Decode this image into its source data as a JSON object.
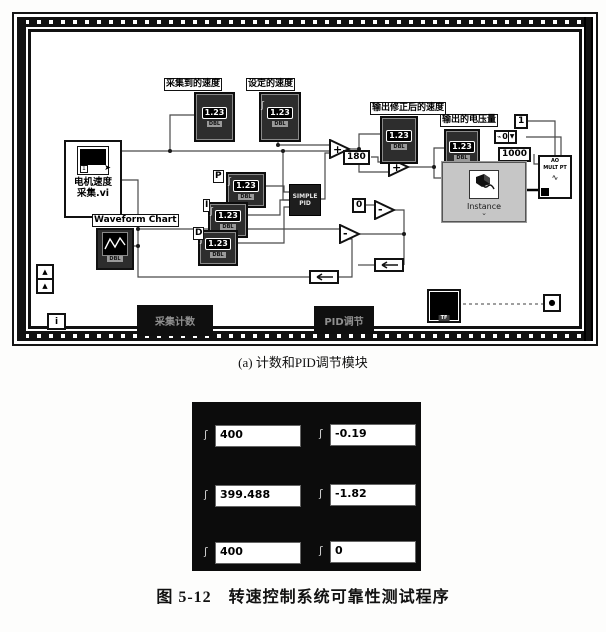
{
  "captions": {
    "sub": "(a) 计数和PID调节模块",
    "main": "图 5-12　转速控制系统可靠性测试程序"
  },
  "diagram": {
    "motor_vi": {
      "line1": "电机速度",
      "line2": "采集.vi",
      "icon_value": "1"
    },
    "waveform_chart": {
      "label": "Waveform Chart",
      "tag": "DBL"
    },
    "collected_speed": {
      "label": "采集到的速度",
      "value": "1.23",
      "tag": "DBL"
    },
    "set_speed": {
      "label": "设定的速度",
      "value": "1.23",
      "tag": "DBL"
    },
    "corrected_speed": {
      "label": "输出修正后的速度",
      "value": "1.23",
      "tag": "DBL"
    },
    "output_voltage": {
      "label": "输出的电压量",
      "value": "1.23",
      "tag": "DBL"
    },
    "pid_gains": {
      "p": {
        "label": "P",
        "value": "1.23",
        "tag": "DBL"
      },
      "i": {
        "label": "I",
        "value": "1.23",
        "tag": "DBL"
      },
      "d": {
        "label": "D",
        "value": "1.23",
        "tag": "DBL"
      }
    },
    "pid_block": {
      "line1": "SIMPLE",
      "line2": "PID"
    },
    "constants": {
      "c180": "180",
      "c0": "0",
      "c1": "1",
      "ring": "0",
      "c1000": "1000"
    },
    "operators": {
      "add": "+",
      "subtract": "-"
    },
    "instance": {
      "label": "Instance"
    },
    "ao": {
      "line1": "AO",
      "line2": "MULT PT"
    },
    "stop": {
      "label": "TF"
    },
    "iteration": {
      "label": "i"
    },
    "tabs": {
      "left": "采集计数",
      "right": "PID调节"
    }
  },
  "front_panel": {
    "rows": [
      {
        "left": "400",
        "right": "-0.19"
      },
      {
        "left": "399.488",
        "right": "-1.82"
      },
      {
        "left": "400",
        "right": "0"
      }
    ]
  },
  "icons": {
    "spinner": "ʃ",
    "dropdown": "▼",
    "shift": "▲",
    "dot": "●",
    "cursor": "➤",
    "io": "⌁",
    "chevron": "⌄",
    "wave": "∿"
  }
}
